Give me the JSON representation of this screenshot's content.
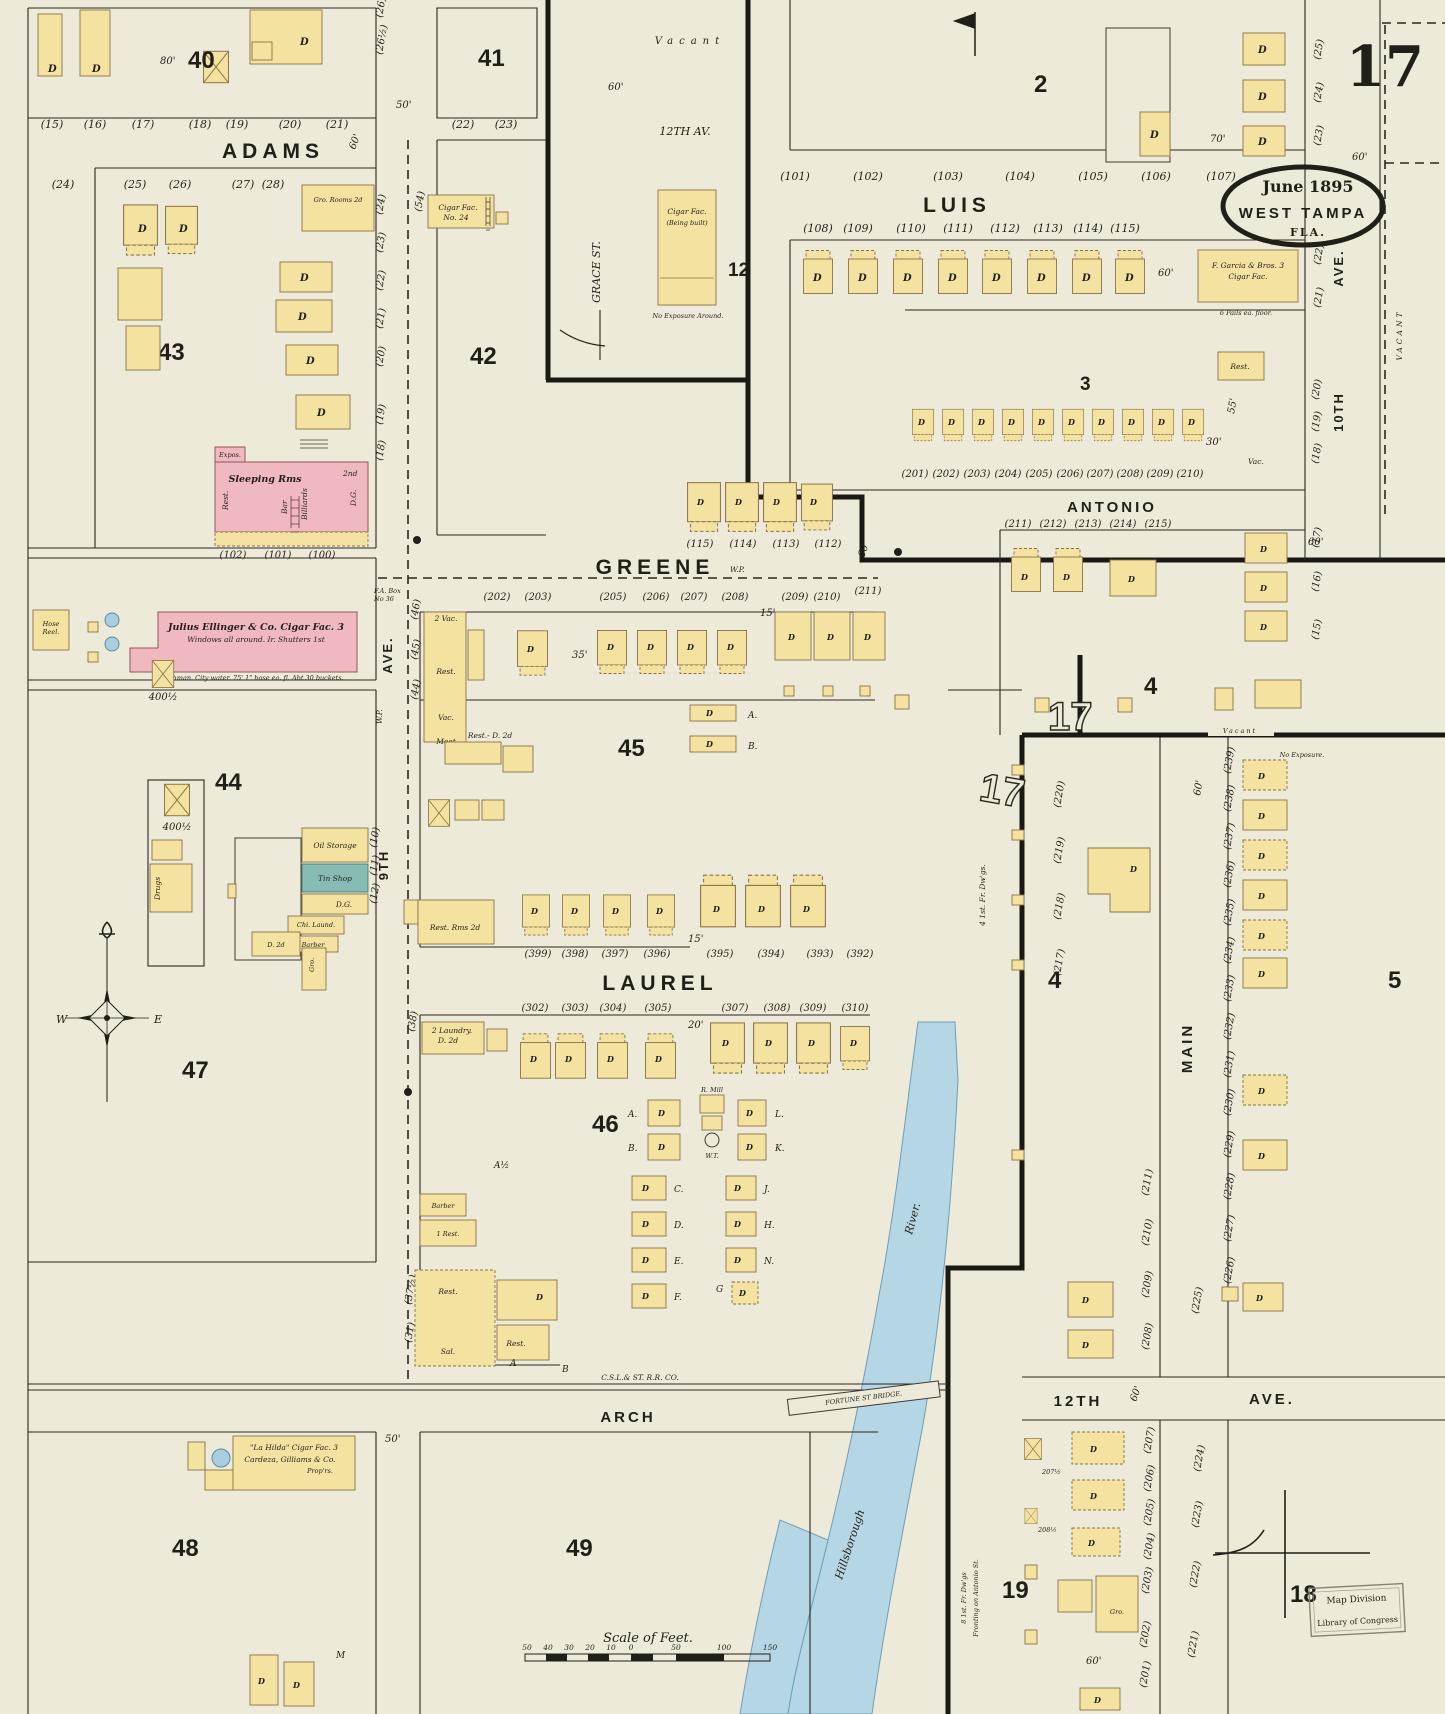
{
  "sheet": {
    "number": "17",
    "date": "June 1895",
    "city": "WEST TAMPA",
    "state": "FLA."
  },
  "streets": {
    "adams": "ADAMS",
    "greene": "GREENE",
    "laurel": "LAUREL",
    "arch": "ARCH",
    "luis": "LUIS",
    "antonio": "ANTONIO",
    "main": "MAIN",
    "grace": "GRACE ST.",
    "ninth": "9TH",
    "ninth_ave": "AVE.",
    "twelfth_av": "12TH AV.",
    "twelfth": "12TH",
    "twelfth_ave": "AVE.",
    "tenth": "10TH",
    "tenth_ave": "AVE.",
    "railroad": "C.S.L.& ST. R.R. CO.",
    "bridge": "FORTUNE ST BRIDGE.",
    "river1": "Hillsborough",
    "river2": "River."
  },
  "blocks": {
    "b40": "40",
    "b41": "41",
    "b42": "42",
    "b43": "43",
    "b44": "44",
    "b45": "45",
    "b46": "46",
    "b47": "47",
    "b48": "48",
    "b49": "49",
    "b2": "2",
    "b3": "3",
    "b4": "4",
    "b5": "5",
    "b12": "12",
    "b17": "17",
    "b18": "18",
    "b19": "19"
  },
  "labels": {
    "d": "D",
    "vac": "Vac.",
    "vac2": "2 Vac.",
    "vacant": "VACANT",
    "vacant_sm": "Vacant",
    "rest": "Rest.",
    "rest1": "1 Rest.",
    "bar": "Bar",
    "billiards": "Billiards",
    "dg": "D.G.",
    "sal": "Sal.",
    "meat": "Meat",
    "barber": "Barber",
    "drugs": "Drugs",
    "sleeping": "Sleeping  Rms",
    "second": "2nd",
    "expos": "Expos.",
    "gro": "Gro.",
    "gro_rooms": "Gro. Rooms 2d",
    "hose1": "Hose",
    "hose2": "Reel.",
    "oil": "Oil Storage",
    "tin": "Tin Shop",
    "chi": "Chi. Laund.",
    "laundry1": "2 Laundry.",
    "laundry2": "D. 2d",
    "rest_rms": "Rest. Rms 2d",
    "rest_d2d": "Rest.- D. 2d",
    "d2d": "D. 2d",
    "wp": "W.P.",
    "fabox1": "F.A. Box",
    "fabox2": "No 36",
    "mill1": "R. Mill",
    "mill2": "W.T.",
    "no_exposure": "No Exposure.",
    "no_exp_around": "No Exposure Around.",
    "fr8_1": "8 1st. Fr. Dw'gs",
    "fr8_2": "Fronting on Antonio St.",
    "fr4": "4 1st. Fr. Dw'gs."
  },
  "special": {
    "ellinger1": "Julius Ellinger & Co. Cigar Fac. 3",
    "ellinger2": "Windows all around. Ir. Shutters 1st",
    "ellinger3": "Watchman. City water. 75' 1\" hose ea. fl. Abt 30 buckets.",
    "lahilda1": "\"La Hilda\" Cigar Fac. 3",
    "lahilda2": "Cardeza, Gilliams & Co.",
    "lahilda3": "Prop'rs.",
    "garcia1": "F. Garcia & Bros. 3",
    "garcia2": "Cigar Fac.",
    "garcia3": "6 Pails ea. floor.",
    "grace_fac1": "Cigar Fac.",
    "grace_fac2": "(Being built)",
    "cigar24_1": "Cigar Fac.",
    "cigar24_2": "No. 24"
  },
  "dims": {
    "d15": "15'",
    "d20": "20'",
    "d30": "30'",
    "d35": "35'",
    "d50": "50'",
    "d55": "55'",
    "d60": "60'",
    "d70": "70'",
    "d80": "80'",
    "n4001": "400½",
    "n2071": "207½",
    "n2081": "208½"
  },
  "letters": {
    "a": "A.",
    "b": "B.",
    "c": "C.",
    "d": "D.",
    "e": "E.",
    "f": "F.",
    "g": "G",
    "h": "H.",
    "j": "J.",
    "k": "K.",
    "l": "L.",
    "n": "N.",
    "m": "M",
    "a_half": "A½",
    "a_plain": "A",
    "b_plain": "B"
  },
  "lots": {
    "adams_n": [
      "(15)",
      "(16)",
      "(17)",
      "(18)",
      "(19)",
      "(20)",
      "(21)"
    ],
    "adams_s": [
      "(24)",
      "(25)",
      "(26)",
      "(27)",
      "(28)"
    ],
    "b41": [
      "(22)",
      "(23)"
    ],
    "b41w": "(54)",
    "col43": [
      "(26)",
      "(26½)",
      "(24)",
      "(23)",
      "(22)",
      "(21)",
      "(20)",
      "(19)",
      "(18)"
    ],
    "b43s": [
      "(102)",
      "(101)",
      "(100)"
    ],
    "luis_n": [
      "(101)",
      "(102)",
      "(103)",
      "(104)",
      "(105)",
      "(106)",
      "(107)"
    ],
    "luis_s": [
      "(108)",
      "(109)",
      "(110)",
      "(111)",
      "(112)",
      "(113)",
      "(114)",
      "(115)"
    ],
    "greene_n": [
      "(115)",
      "(114)",
      "(113)",
      "(112)"
    ],
    "b3": [
      "(201)",
      "(202)",
      "(203)",
      "(204)",
      "(205)",
      "(206)",
      "(207)",
      "(208)",
      "(209)",
      "(210)"
    ],
    "antonio_s": [
      "(211)",
      "(212)",
      "(213)",
      "(214)",
      "(215)"
    ],
    "col10a": [
      "(25)",
      "(24)",
      "(23)"
    ],
    "col10b": [
      "(22)",
      "(21)"
    ],
    "col10c": [
      "(20)",
      "(19)",
      "(18)"
    ],
    "col10d": [
      "(17)",
      "(16)",
      "(15)"
    ],
    "greene_s": [
      "(202)",
      "(203)",
      "(205)",
      "(206)",
      "(207)",
      "(208)",
      "(209)",
      "(210)",
      "(211)"
    ],
    "col9a": [
      "(46)",
      "(45)",
      "(44)"
    ],
    "col9b": [
      "(10)",
      "(11)",
      "(12)"
    ],
    "col9c": "(39)",
    "col9e": "(38)",
    "col9d": [
      "(37½)",
      "(31)"
    ],
    "laurel_n": [
      "(399)",
      "(398)",
      "(397)",
      "(396)",
      "(395)",
      "(394)",
      "(393)",
      "(392)"
    ],
    "laurel_s": [
      "(302)",
      "(303)",
      "(304)",
      "(305)",
      "(307)",
      "(308)",
      "(309)",
      "(310)"
    ],
    "col5": [
      "(239)",
      "(238)",
      "(237)",
      "(236)",
      "(235)",
      "(234)",
      "(233)",
      "(232)",
      "(231)",
      "(230)",
      "(229)",
      "(228)",
      "(227)",
      "(226)"
    ],
    "col4e": [
      "(220)",
      "(219)",
      "(218)",
      "(217)"
    ],
    "col_main_w2": [
      "(211)",
      "(210)",
      "(209)",
      "(208)"
    ],
    "col19e": [
      "(207)",
      "(206)",
      "(205)",
      "(204)",
      "(203)",
      "(202)",
      "(201)"
    ],
    "col18w": [
      "(225)",
      "(224)",
      "(223)",
      "(222)",
      "(221)"
    ]
  },
  "scalebar": {
    "title": "Scale of Feet.",
    "nums": [
      "50",
      "40",
      "30",
      "20",
      "10",
      "0",
      "50",
      "100",
      "150"
    ]
  },
  "stamp": {
    "l1": "Map Division",
    "l2": "Library of Congress"
  },
  "compass": {
    "w": "W",
    "e": "E",
    "n": "N",
    "s": "S"
  }
}
